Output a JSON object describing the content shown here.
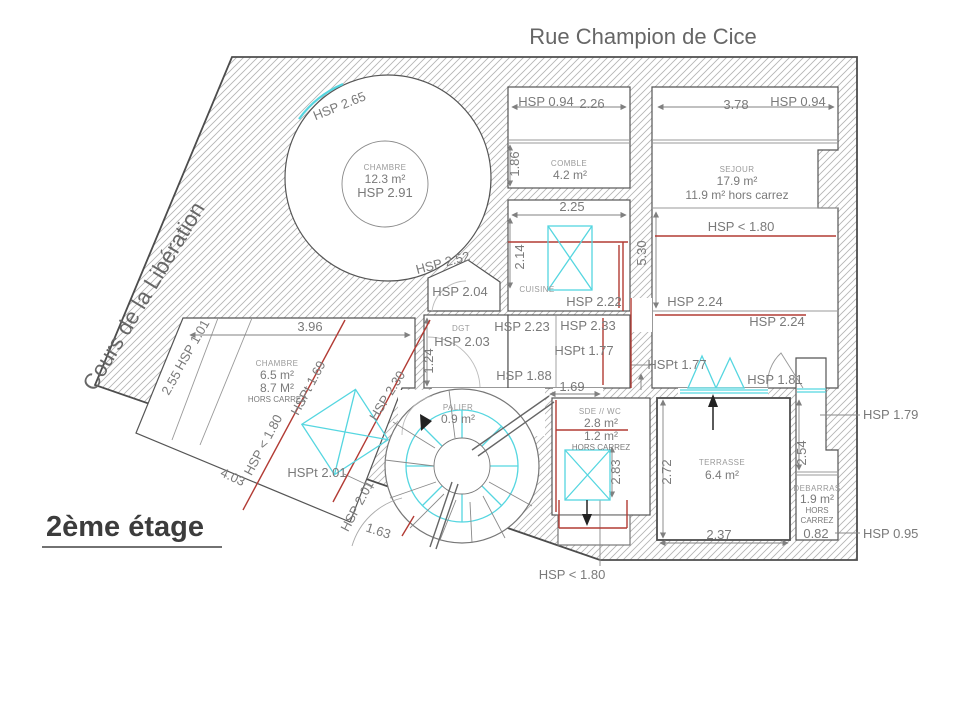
{
  "title": {
    "floor": "2ème étage"
  },
  "streets": {
    "top": "Rue Champion de Cice",
    "left": "Cours de la Libération"
  },
  "rooms": {
    "chambre_ronde": {
      "name": "CHAMBRE",
      "area": "12.3 m²",
      "hsp": "HSP 2.91",
      "hsp_window": "HSP 2.65",
      "hsp_edge": "HSP 2.52",
      "hsp_vestibule": "HSP 2.04"
    },
    "comble": {
      "name": "COMBLE",
      "area": "4.2 m²",
      "hsp": "HSP 0.94",
      "dim_w": "2.26",
      "dim_h": "1.86"
    },
    "sejour": {
      "name": "SEJOUR",
      "area": "17.9 m²",
      "hors_carrez": "11.9 m² hors carrez",
      "hsp_top": "HSP 0.94",
      "dim_w": "3.78",
      "hsp_low": "HSP < 1.80",
      "dim_h": "5.30",
      "hsp_mid": "HSP 2.24",
      "hsp_mid2": "HSP 2.24"
    },
    "cuisine": {
      "name": "CUISINE",
      "dim_w": "2.25",
      "dim_h": "2.14",
      "hsp": "HSP 2.22"
    },
    "dgt": {
      "name": "DGT",
      "hsp": "HSP 2.03",
      "dim_h": "1.24"
    },
    "couloir": {
      "hsp_a": "HSP 2.23",
      "hsp_b": "HSP 2.33",
      "hspt": "HSPt 1.77",
      "hsp_c": "HSP 1.88"
    },
    "palier": {
      "name": "PALIER",
      "area": "0.9 m²"
    },
    "sde_wc": {
      "name": "SDE // WC",
      "area": "2.8 m²",
      "area_hc": "1.2 m²",
      "hors_carrez": "HORS CARREZ",
      "dim_w": "1.69",
      "dim_h": "2.83",
      "hsp_below": "HSP < 1.80"
    },
    "terrasse": {
      "name": "TERRASSE",
      "area": "6.4 m²",
      "dim_h": "2.72",
      "dim_w": "2.37",
      "hspt": "HSPt 1.77",
      "hsp_door": "HSP 1.81"
    },
    "debarras": {
      "name": "DEBARRAS",
      "area": "1.9 m²",
      "hors_line1": "HORS",
      "hors_line2": "CARREZ",
      "dim_w": "0.82",
      "dim_h": "2.54",
      "hsp_right": "HSP 1.79",
      "hsp_bottom": "HSP 0.95"
    },
    "chambre2": {
      "name": "CHAMBRE",
      "area": "6.5 m²",
      "area2": "8.7 M²",
      "hors_carrez": "HORS CARREZ",
      "dim_top": "3.96",
      "dim_left": "2.55",
      "hsp_left": "HSP 1.01",
      "hsp_zone": "HSP < 1.80",
      "hspt_zone": "HSPt 1.69",
      "hsp_zone2": "HSP 2.30",
      "dim_bottom": "4.03",
      "hspt_door": "HSPt 2.01",
      "hsp_door": "HSP 2.01",
      "dim_door": "1.63"
    }
  },
  "colors": {
    "carrez_red": "#b23b34",
    "skylight_cyan": "#55d6e0",
    "wall": "#4d4d4d",
    "text_gray": "#7a7a7a"
  }
}
